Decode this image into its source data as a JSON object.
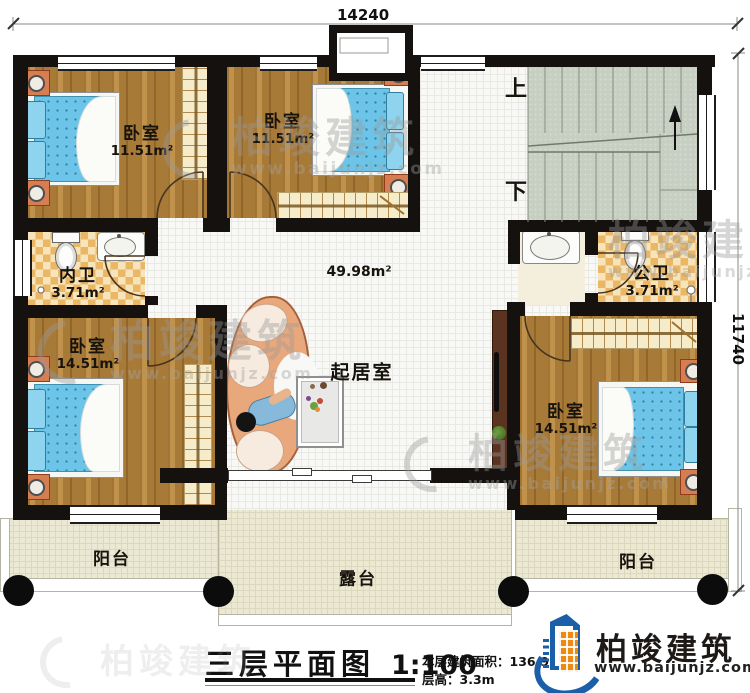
{
  "dims": {
    "top": "14240",
    "right": "11740"
  },
  "stairs": {
    "up_label": "上",
    "down_label": "下"
  },
  "rooms": {
    "bedroom_tl": {
      "name": "卧室",
      "area": "11.51m²"
    },
    "bedroom_tm": {
      "name": "卧室",
      "area": "11.51m²"
    },
    "bath_left": {
      "name": "内卫",
      "area": "3.71m²"
    },
    "bath_right": {
      "name": "公卫",
      "area": "3.71m²"
    },
    "bedroom_bl": {
      "name": "卧室",
      "area": "14.51m²"
    },
    "bedroom_br": {
      "name": "卧室",
      "area": "14.51m²"
    },
    "hall": {
      "area": "49.98m²"
    },
    "living": {
      "name": "起居室"
    },
    "balcony_left": {
      "name": "阳台"
    },
    "balcony_right": {
      "name": "阳台"
    },
    "terrace": {
      "name": "露台"
    }
  },
  "footer": {
    "title": "三层平面图",
    "scale": "1:100",
    "area_label": "本层建筑面积：",
    "area_value": "136.92m²",
    "height_label": "层高：",
    "height_value": "3.3m"
  },
  "brand": {
    "name": "柏竣建筑",
    "website": "www.baijunjz.com"
  },
  "watermark": {
    "name": "柏竣建筑",
    "website": "www.baijunjz.com"
  },
  "colors": {
    "wall": "#14110e",
    "wood": "#b5833c",
    "hall_tile": "#f8f8f6",
    "checker_dark": "#e9b765",
    "checker_light": "#f7e4ba",
    "stairs": "#c6cfc2",
    "outdoor": "#ebe8d3",
    "mattress": "#6cc5e8",
    "sofa": "#e9a87c",
    "brand_blue": "#1b5fa8",
    "brand_orange": "#f0890f",
    "watermark_gray": "#9a9a9a"
  }
}
